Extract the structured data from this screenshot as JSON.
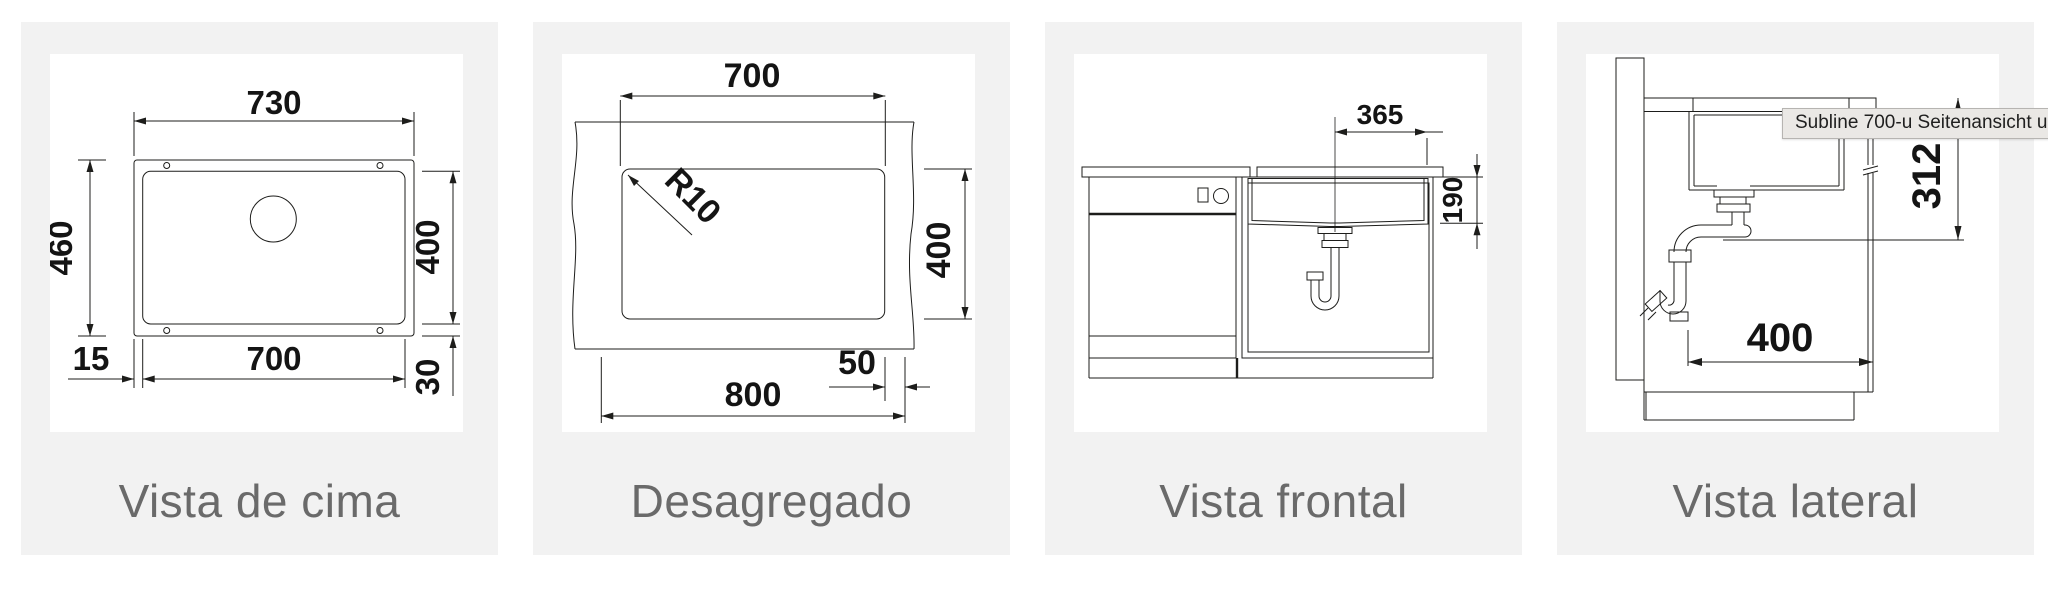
{
  "colors": {
    "card_bg": "#f2f2f2",
    "canvas_bg": "#ffffff",
    "line": "#1d1d1b",
    "label_text": "#6a6a6a",
    "tooltip_bg": "#eae8e5",
    "tooltip_border": "#b6b4b1"
  },
  "tooltip": {
    "text": "Subline 700-u Seitenansicht unte"
  },
  "panels": [
    {
      "id": "top-view",
      "label": "Vista de cima",
      "dims": {
        "outer_width": "730",
        "outer_height": "460",
        "bowl_height": "400",
        "bowl_width": "700",
        "flange_side": "15",
        "flange_bottom": "30"
      }
    },
    {
      "id": "cutout",
      "label": "Desagregado",
      "dims": {
        "cutout_width": "700",
        "cutout_height": "400",
        "worktop_width": "800",
        "edge_offset": "50",
        "corner_radius": "R10"
      }
    },
    {
      "id": "front-view",
      "label": "Vista frontal",
      "dims": {
        "center_to_edge": "365",
        "bowl_depth": "190"
      }
    },
    {
      "id": "side-view",
      "label": "Vista lateral",
      "dims": {
        "install_height": "312",
        "cabinet_depth": "400"
      }
    }
  ]
}
